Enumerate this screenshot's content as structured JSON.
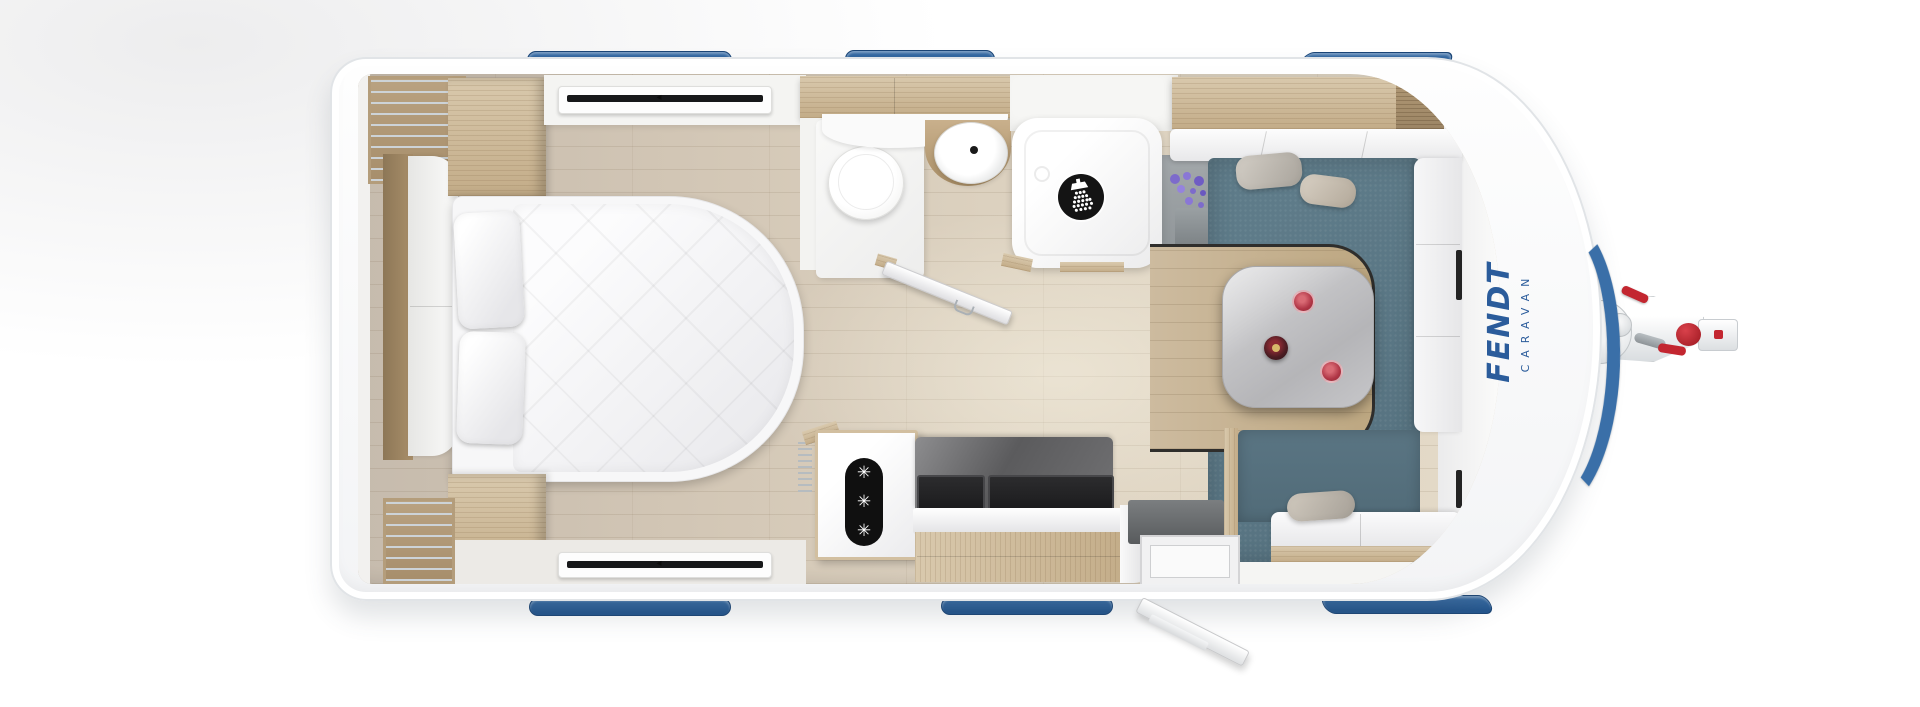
{
  "meta": {
    "view": "caravan floor plan, top-down render"
  },
  "branding": {
    "primary": "FENDT",
    "secondary": "CARAVAN"
  },
  "theme": {
    "accent_blue": "#3a6fa8",
    "accent_blue_deep": "#24568e",
    "logo_blue": "#2b5c9b",
    "carpet_blue": "#5e7b89",
    "carpet_blue_dark": "#54707e",
    "wood_light": "#d9c9ad",
    "wood_mid": "#c3ac88",
    "wood_dark": "#9c8565",
    "marble_table_light": "#d6d6d8",
    "marble_table_dark": "#b5b5b8",
    "backsplash_dark": "#626264",
    "hitch_red": "#c32630",
    "icon_black": "#141414",
    "flower_purple": "#7d6bcb",
    "shell_white": "#ffffff"
  },
  "icons": {
    "shower": {
      "name": "shower-head-icon",
      "fg": "#ffffff",
      "bg": "#141414"
    },
    "freezer": {
      "name": "freezer-snowflakes-icon",
      "glyph": "✳",
      "count": 3,
      "fg": "#ffffff",
      "bg": "#101010"
    },
    "window_latch": {
      "name": "window-latch-icon",
      "glyph": "◂"
    }
  },
  "fixtures": [
    "roof-skylight",
    "wardrobe",
    "overhead-locker",
    "double-bed",
    "pillow",
    "window",
    "toilet",
    "washbasin",
    "bathroom-door",
    "shower",
    "houseplant",
    "dinette-table",
    "wine-bottle",
    "wine-glass",
    "seating-bench",
    "cushion",
    "fridge-freezer",
    "kitchen-unit",
    "hob-sink-cover",
    "entry-step",
    "entry-door",
    "drawbar-hitch",
    "jockey-wheel",
    "coupling-head"
  ]
}
